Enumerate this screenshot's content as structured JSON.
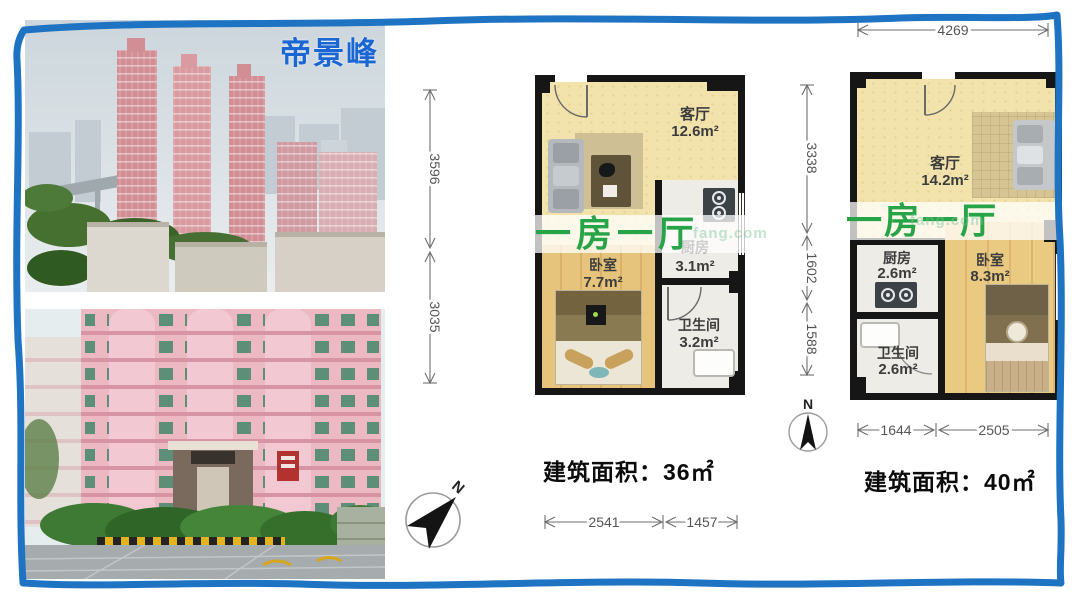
{
  "project": {
    "title": "帝景峰",
    "title_color": "#1a66d2"
  },
  "colors": {
    "frame_border": "#1e73c3",
    "banner_green": "#27a348",
    "wall": "#161616"
  },
  "watermark": {
    "text": "fang.com"
  },
  "compass": {
    "north": "N"
  },
  "plan_small": {
    "banner": "一房一厅",
    "area_text": "建筑面积：36㎡",
    "rooms": {
      "living": {
        "name": "客厅",
        "area": "12.6m²"
      },
      "kitchen": {
        "name": "厨房",
        "area": "3.1m²"
      },
      "bedroom": {
        "name": "卧室",
        "area": "7.7m²"
      },
      "bath": {
        "name": "卫生间",
        "area": "3.2m²"
      }
    },
    "dims": {
      "v1": "3596",
      "v2": "3035",
      "b1": "2541",
      "b2": "1457"
    }
  },
  "plan_large": {
    "banner": "一房一厅",
    "area_text": "建筑面积：40㎡",
    "rooms": {
      "living": {
        "name": "客厅",
        "area": "14.2m²"
      },
      "kitchen": {
        "name": "厨房",
        "area": "2.6m²"
      },
      "bedroom": {
        "name": "卧室",
        "area": "8.3m²"
      },
      "bath": {
        "name": "卫生间",
        "area": "2.6m²"
      }
    },
    "dims": {
      "top": "4269",
      "v1": "3338",
      "v2": "1602",
      "v3": "1588",
      "b1": "1644",
      "b2": "2505"
    }
  }
}
